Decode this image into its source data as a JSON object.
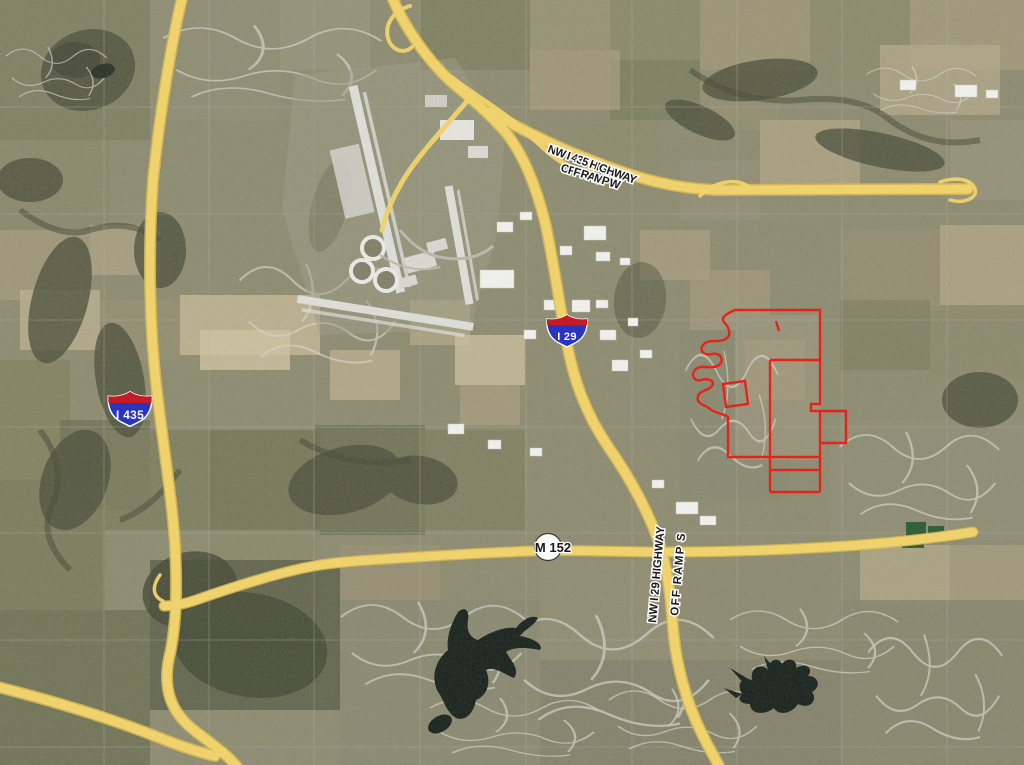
{
  "shields": {
    "i435": "I 435",
    "i29": "I 29",
    "m152": "M 152"
  },
  "road_labels": {
    "nw_i435_line1": "NW I 435 HIGHWAY",
    "nw_i435_line2": "OFF RAMP W",
    "nw_i29_line1": "NW I 29 HIGHWAY",
    "nw_i29_line2": "OFF RAMP S"
  },
  "colors": {
    "highway_fill": "#F3D468",
    "highway_edge": "#D8B84E",
    "parcel_outline": "#E8190F",
    "interstate_blue": "#1F2BC0",
    "interstate_red": "#C6101C",
    "route_circle_fill": "#FDFDFB",
    "water": "#18221B"
  }
}
